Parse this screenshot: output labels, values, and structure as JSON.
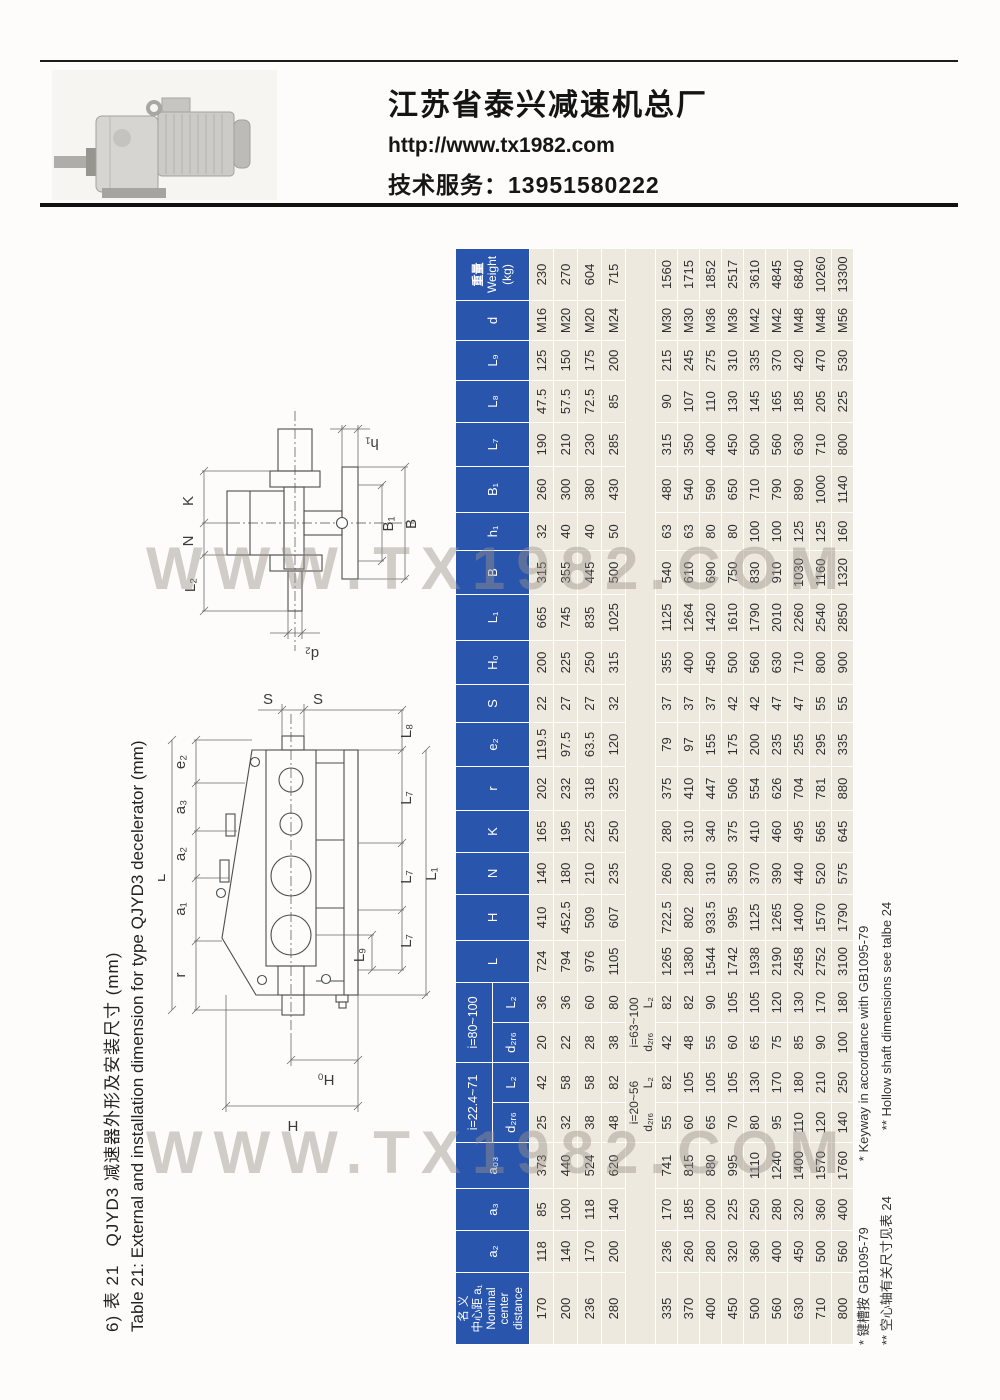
{
  "page": {
    "company": "江苏省泰兴减速机总厂",
    "website": "http://www.tx1982.com",
    "service_label": "技术服务：",
    "service_phone": "13951580222",
    "watermark": "WWW.TX1982.COM"
  },
  "caption": {
    "zh": "6) 表 21　QJYD3 减速器外形及安装尺寸 (mm)",
    "en": "Table 21: External and installation dimension for type QJYD3 decelerator (mm)"
  },
  "table": {
    "corner_lines": [
      "名 义",
      "中心距 a₁",
      "Nominal",
      "center",
      "distance"
    ],
    "lead_headers": [
      "a₂",
      "a₃",
      "a₀₃"
    ],
    "groups": [
      {
        "label": "i=22.4~71",
        "subs": [
          "d₂ᵣ₆",
          "L₂"
        ]
      },
      {
        "label": "i=80~100",
        "subs": [
          "d₂ᵣ₆",
          "L₂"
        ]
      }
    ],
    "tail_headers": [
      "L",
      "H",
      "N",
      "K",
      "r",
      "e₂",
      "S",
      "H₀",
      "L₁",
      "B",
      "h₁",
      "B₁",
      "L₇",
      "L₈",
      "L₉",
      "d"
    ],
    "weight_lines": [
      "重量",
      "Weight",
      "(kg)"
    ],
    "separator": {
      "groups": [
        {
          "label": "i=20~56",
          "subs": [
            "d₂ᵣ₆",
            "L₂"
          ]
        },
        {
          "label": "i=63~100",
          "subs": [
            "d₂ᵣ₆",
            "L₂"
          ]
        }
      ]
    },
    "rows_upper": [
      [
        "170",
        "118",
        "85",
        "373",
        "25",
        "42",
        "20",
        "36",
        "724",
        "410",
        "140",
        "165",
        "202",
        "119.5",
        "22",
        "200",
        "665",
        "315",
        "32",
        "260",
        "190",
        "47.5",
        "125",
        "M16",
        "230"
      ],
      [
        "200",
        "140",
        "100",
        "440",
        "32",
        "58",
        "22",
        "36",
        "794",
        "452.5",
        "180",
        "195",
        "232",
        "97.5",
        "27",
        "225",
        "745",
        "355",
        "40",
        "300",
        "210",
        "57.5",
        "150",
        "M20",
        "270"
      ],
      [
        "236",
        "170",
        "118",
        "524",
        "38",
        "58",
        "28",
        "60",
        "976",
        "509",
        "210",
        "225",
        "318",
        "63.5",
        "27",
        "250",
        "835",
        "445",
        "40",
        "380",
        "230",
        "72.5",
        "175",
        "M20",
        "604"
      ],
      [
        "280",
        "200",
        "140",
        "620",
        "48",
        "82",
        "38",
        "80",
        "1105",
        "607",
        "235",
        "250",
        "325",
        "120",
        "32",
        "315",
        "1025",
        "500",
        "50",
        "430",
        "285",
        "85",
        "200",
        "M24",
        "715"
      ]
    ],
    "rows_lower": [
      [
        "335",
        "236",
        "170",
        "741",
        "55",
        "82",
        "42",
        "82",
        "1265",
        "722.5",
        "260",
        "280",
        "375",
        "79",
        "37",
        "355",
        "1125",
        "540",
        "63",
        "480",
        "315",
        "90",
        "215",
        "M30",
        "1560"
      ],
      [
        "370",
        "260",
        "185",
        "815",
        "60",
        "105",
        "48",
        "82",
        "1380",
        "802",
        "280",
        "310",
        "410",
        "97",
        "37",
        "400",
        "1264",
        "610",
        "63",
        "540",
        "350",
        "107",
        "245",
        "M30",
        "1715"
      ],
      [
        "400",
        "280",
        "200",
        "880",
        "65",
        "105",
        "55",
        "90",
        "1544",
        "933.5",
        "310",
        "340",
        "447",
        "155",
        "37",
        "450",
        "1420",
        "690",
        "80",
        "590",
        "400",
        "110",
        "275",
        "M36",
        "1852"
      ],
      [
        "450",
        "320",
        "225",
        "995",
        "70",
        "105",
        "60",
        "105",
        "1742",
        "995",
        "350",
        "375",
        "506",
        "175",
        "42",
        "500",
        "1610",
        "750",
        "80",
        "650",
        "450",
        "130",
        "310",
        "M36",
        "2517"
      ],
      [
        "500",
        "360",
        "250",
        "1110",
        "80",
        "130",
        "65",
        "105",
        "1938",
        "1125",
        "370",
        "410",
        "554",
        "200",
        "42",
        "560",
        "1790",
        "830",
        "100",
        "710",
        "500",
        "145",
        "335",
        "M42",
        "3610"
      ],
      [
        "560",
        "400",
        "280",
        "1240",
        "95",
        "170",
        "75",
        "120",
        "2190",
        "1265",
        "390",
        "460",
        "626",
        "235",
        "47",
        "630",
        "2010",
        "910",
        "100",
        "790",
        "560",
        "165",
        "370",
        "M42",
        "4845"
      ],
      [
        "630",
        "450",
        "320",
        "1400",
        "110",
        "180",
        "85",
        "130",
        "2458",
        "1400",
        "440",
        "495",
        "704",
        "255",
        "47",
        "710",
        "2260",
        "1030",
        "125",
        "890",
        "630",
        "185",
        "420",
        "M48",
        "6840"
      ],
      [
        "710",
        "500",
        "360",
        "1570",
        "120",
        "210",
        "90",
        "170",
        "2752",
        "1570",
        "520",
        "565",
        "781",
        "295",
        "55",
        "800",
        "2540",
        "1160",
        "125",
        "1000",
        "710",
        "205",
        "470",
        "M48",
        "10260"
      ],
      [
        "800",
        "560",
        "400",
        "1760",
        "140",
        "250",
        "100",
        "180",
        "3100",
        "1790",
        "575",
        "645",
        "880",
        "335",
        "55",
        "900",
        "2850",
        "1320",
        "160",
        "1140",
        "800",
        "225",
        "530",
        "M56",
        "13300"
      ]
    ],
    "footnotes": [
      {
        "zh": "* 键槽按 GB1095-79",
        "en": "* Keyway in accordance with GB1095-79"
      },
      {
        "zh": "** 空心轴有关尺寸见表 24",
        "en": "** Hollow shaft dimensions see talbe 24"
      }
    ]
  },
  "drawings": {
    "d1": {
      "labels": {
        "h1": "h₁",
        "K": "K",
        "N": "N",
        "L2": "L₂",
        "B1": "B₁",
        "B": "B",
        "d2": "d₂"
      }
    },
    "d2": {
      "labels": {
        "S1": "S",
        "S2": "S",
        "L8": "L₈",
        "e2": "e₂",
        "a3": "a₃",
        "a2": "a₂",
        "a1": "a₁",
        "L": "L",
        "r": "r",
        "L7a": "L₇",
        "L7b": "L₇",
        "L7c": "L₇",
        "L1": "L₁",
        "L9": "L₉",
        "H0": "H₀",
        "H": "H"
      }
    }
  }
}
